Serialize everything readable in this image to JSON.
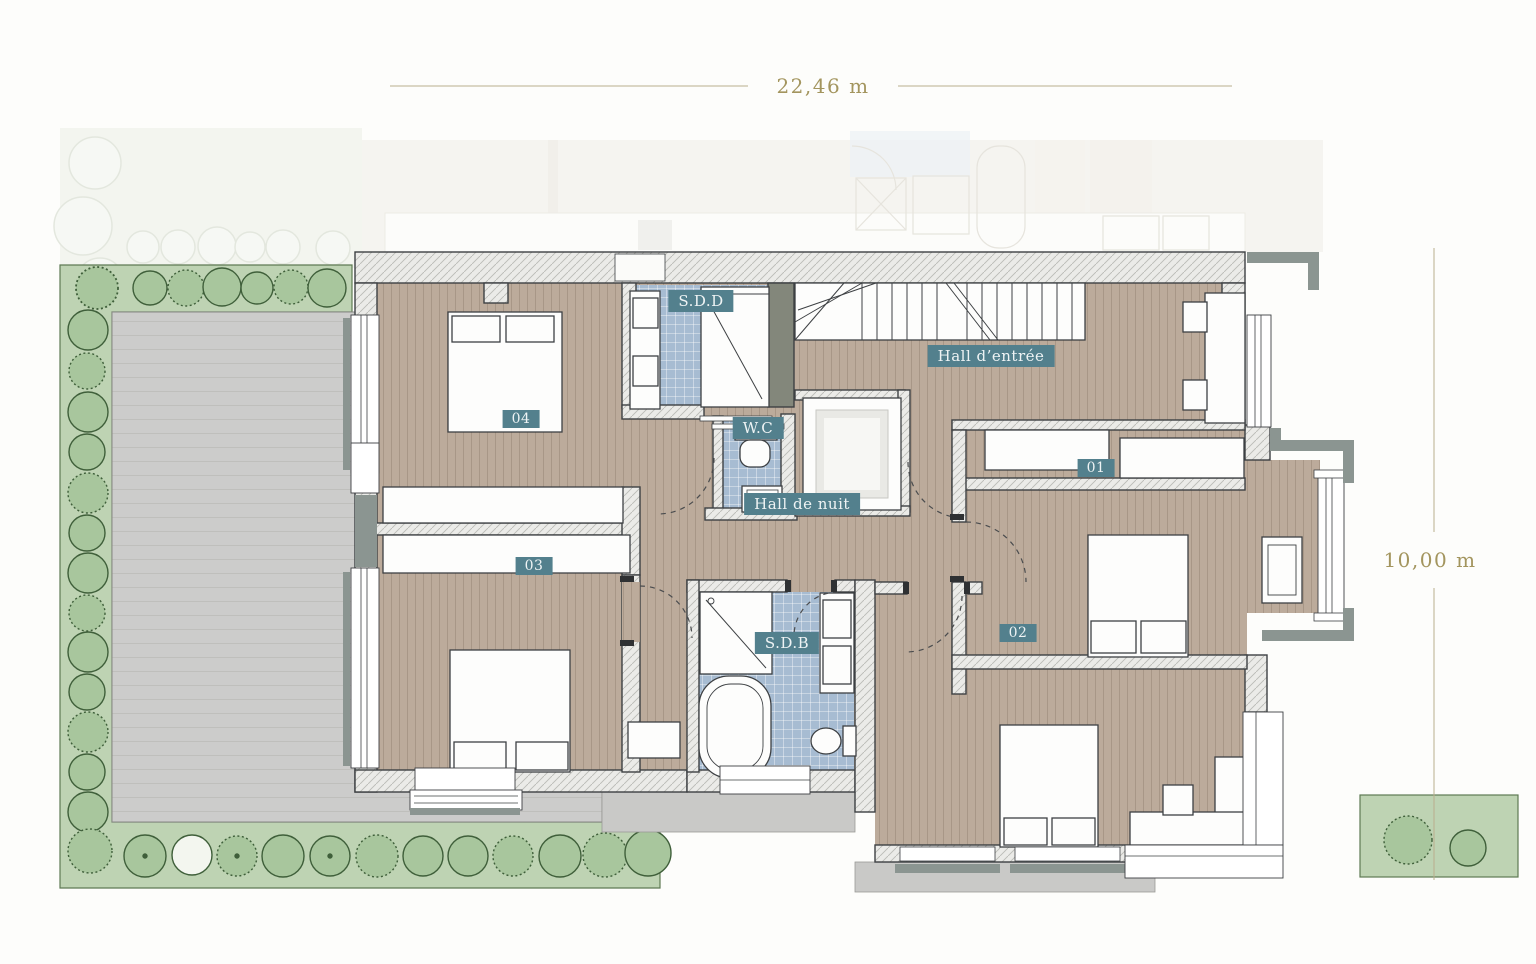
{
  "plan": {
    "type": "floor-plan",
    "dimensions": {
      "width_label": "22,46 m",
      "height_label": "10,00 m"
    },
    "rooms": {
      "sdd": "S.D.D",
      "wc": "W.C",
      "hall_entree": "Hall d’entrée",
      "hall_nuit": "Hall de nuit",
      "sdb": "S.D.B",
      "bedroom_01": "01",
      "bedroom_02": "02",
      "bedroom_03": "03",
      "bedroom_04": "04"
    },
    "colors": {
      "badge_teal": "#53808d",
      "dimension_text": "#a3955e",
      "wood_floor": "#bcab9b",
      "tile_floor": "#a7bcd2",
      "garden_band": "#bed3b3",
      "bush_green": "#a8c69d",
      "terrace_gray": "#cccccb",
      "trim_gray": "#8b9591",
      "wall_outline": "#3d4043"
    }
  }
}
